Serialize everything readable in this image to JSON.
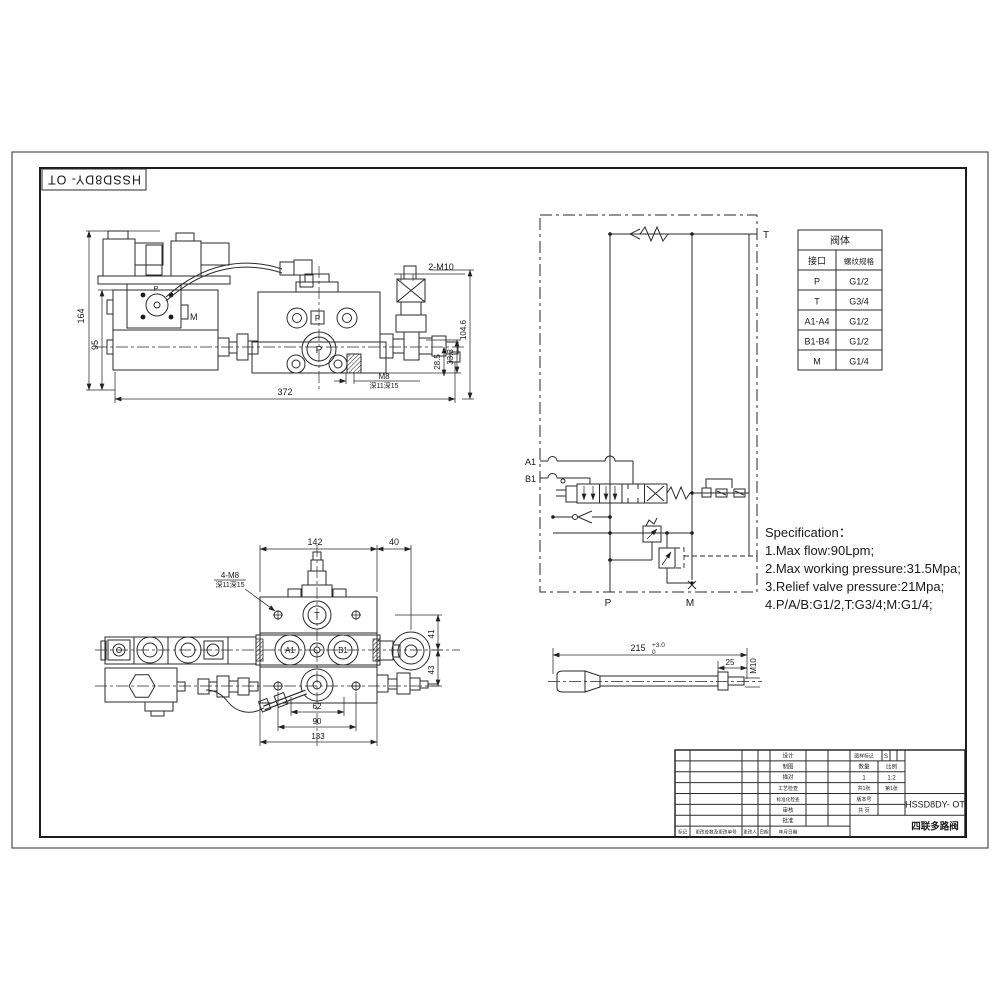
{
  "sheet": {
    "code_box": "HSSD8DY- OT",
    "title_code": "HSSD8DY- OT",
    "title_name": "四联多路阀"
  },
  "side_view": {
    "dim_height_total": "164",
    "dim_height_body": "95",
    "dim_width_total": "372",
    "dim_thread_top": "2-M10",
    "dim_height_right": "104.6",
    "dim_offset_a": "28.5",
    "dim_offset_b": "33.3",
    "dim_thread_bottom": "M8",
    "dim_thread_bottom_note": "深11深15",
    "label_p_pilot": "P",
    "label_m": "M",
    "label_p_main": "P"
  },
  "top_view": {
    "dim_width_main": "142",
    "dim_width_side": "40",
    "dim_thread_holes": "4-M8",
    "dim_thread_holes_note": "深11深15",
    "dim_height_a": "41",
    "dim_height_b": "43",
    "dim_span_a": "62",
    "dim_span_b": "90",
    "dim_span_c": "133",
    "label_t": "T",
    "label_a1": "A1",
    "label_b1": "B1"
  },
  "schematic": {
    "label_t": "T",
    "label_a1": "A1",
    "label_b1": "B1",
    "label_p": "P",
    "label_m": "M"
  },
  "port_table": {
    "title": "阀体",
    "col_port": "接口",
    "col_thread": "螺纹规格",
    "rows": [
      [
        "P",
        "G1/2"
      ],
      [
        "T",
        "G3/4"
      ],
      [
        "A1-A4",
        "G1/2"
      ],
      [
        "B1-B4",
        "G1/2"
      ],
      [
        "M",
        "G1/4"
      ]
    ]
  },
  "specification": {
    "title": "Specification：",
    "line1": "1.Max flow:90Lpm;",
    "line2": "2.Max working pressure:31.5Mpa;",
    "line3": "3.Relief valve pressure:21Mpa;",
    "line4": "4.P/A/B:G1/2,T:G3/4;M:G1/4;"
  },
  "lever": {
    "dim_length": "215",
    "dim_length_tol_upper": "+3.0",
    "dim_length_tol_lower": "0",
    "dim_thread_length": "25",
    "dim_thread": "M10"
  },
  "title_block": {
    "sign_rows": [
      "设计",
      "制图",
      "描对",
      "工艺检查",
      "标准化检查",
      "审核",
      "批准"
    ],
    "bottom_row": [
      "标记",
      "更改处数及更改单号",
      "更改人",
      "日期",
      "年月日期"
    ],
    "stage_label": "图样标记",
    "stage_value": "S",
    "qty_label": "数量",
    "scale_label": "比例",
    "qty_value": "1",
    "scale_value": "1:2",
    "sheets_label": "共1张",
    "sheet_no_label": "第1张",
    "version_label": "版本号",
    "pages_label": "共 页"
  }
}
